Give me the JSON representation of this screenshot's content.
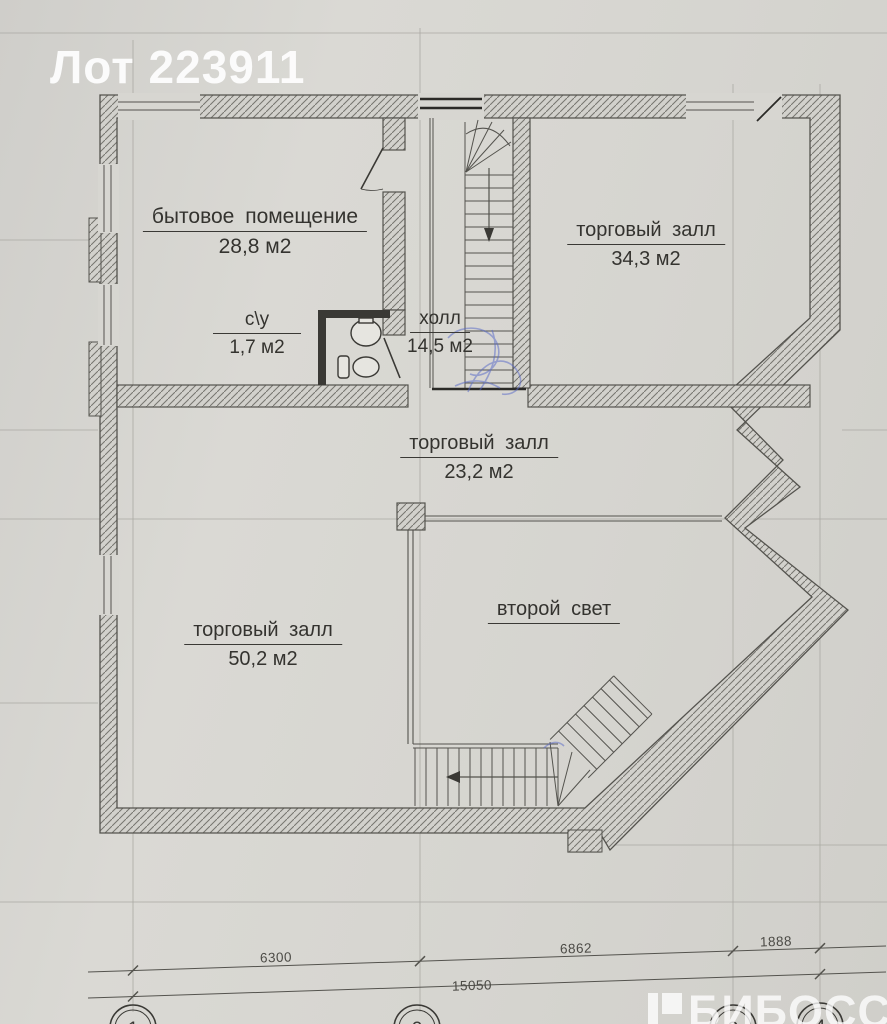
{
  "watermarks": {
    "lot": "Лот 223911",
    "brand": "БИБОСС"
  },
  "rooms": [
    {
      "name": "бытовое помещение",
      "area": "28,8 м2"
    },
    {
      "name": "торговый залл",
      "area": "34,3 м2"
    },
    {
      "name": "с\\у",
      "area": "1,7 м2"
    },
    {
      "name": "холл",
      "area": "14,5 м2"
    },
    {
      "name": "торговый залл",
      "area": "23,2 м2"
    },
    {
      "name": "торговый залл",
      "area": "50,2 м2"
    },
    {
      "name": "второй свет",
      "area": ""
    }
  ],
  "dimensions": {
    "segments": [
      "6300",
      "6862",
      "1888"
    ],
    "total": "15050"
  },
  "grid_bubbles": [
    "1",
    "2",
    "3",
    "4"
  ],
  "colors": {
    "paper": "#d7d6d1",
    "ink": "#54534e",
    "label": "#34332f",
    "watermark": "#ffffff",
    "pen": "#5566c8"
  }
}
